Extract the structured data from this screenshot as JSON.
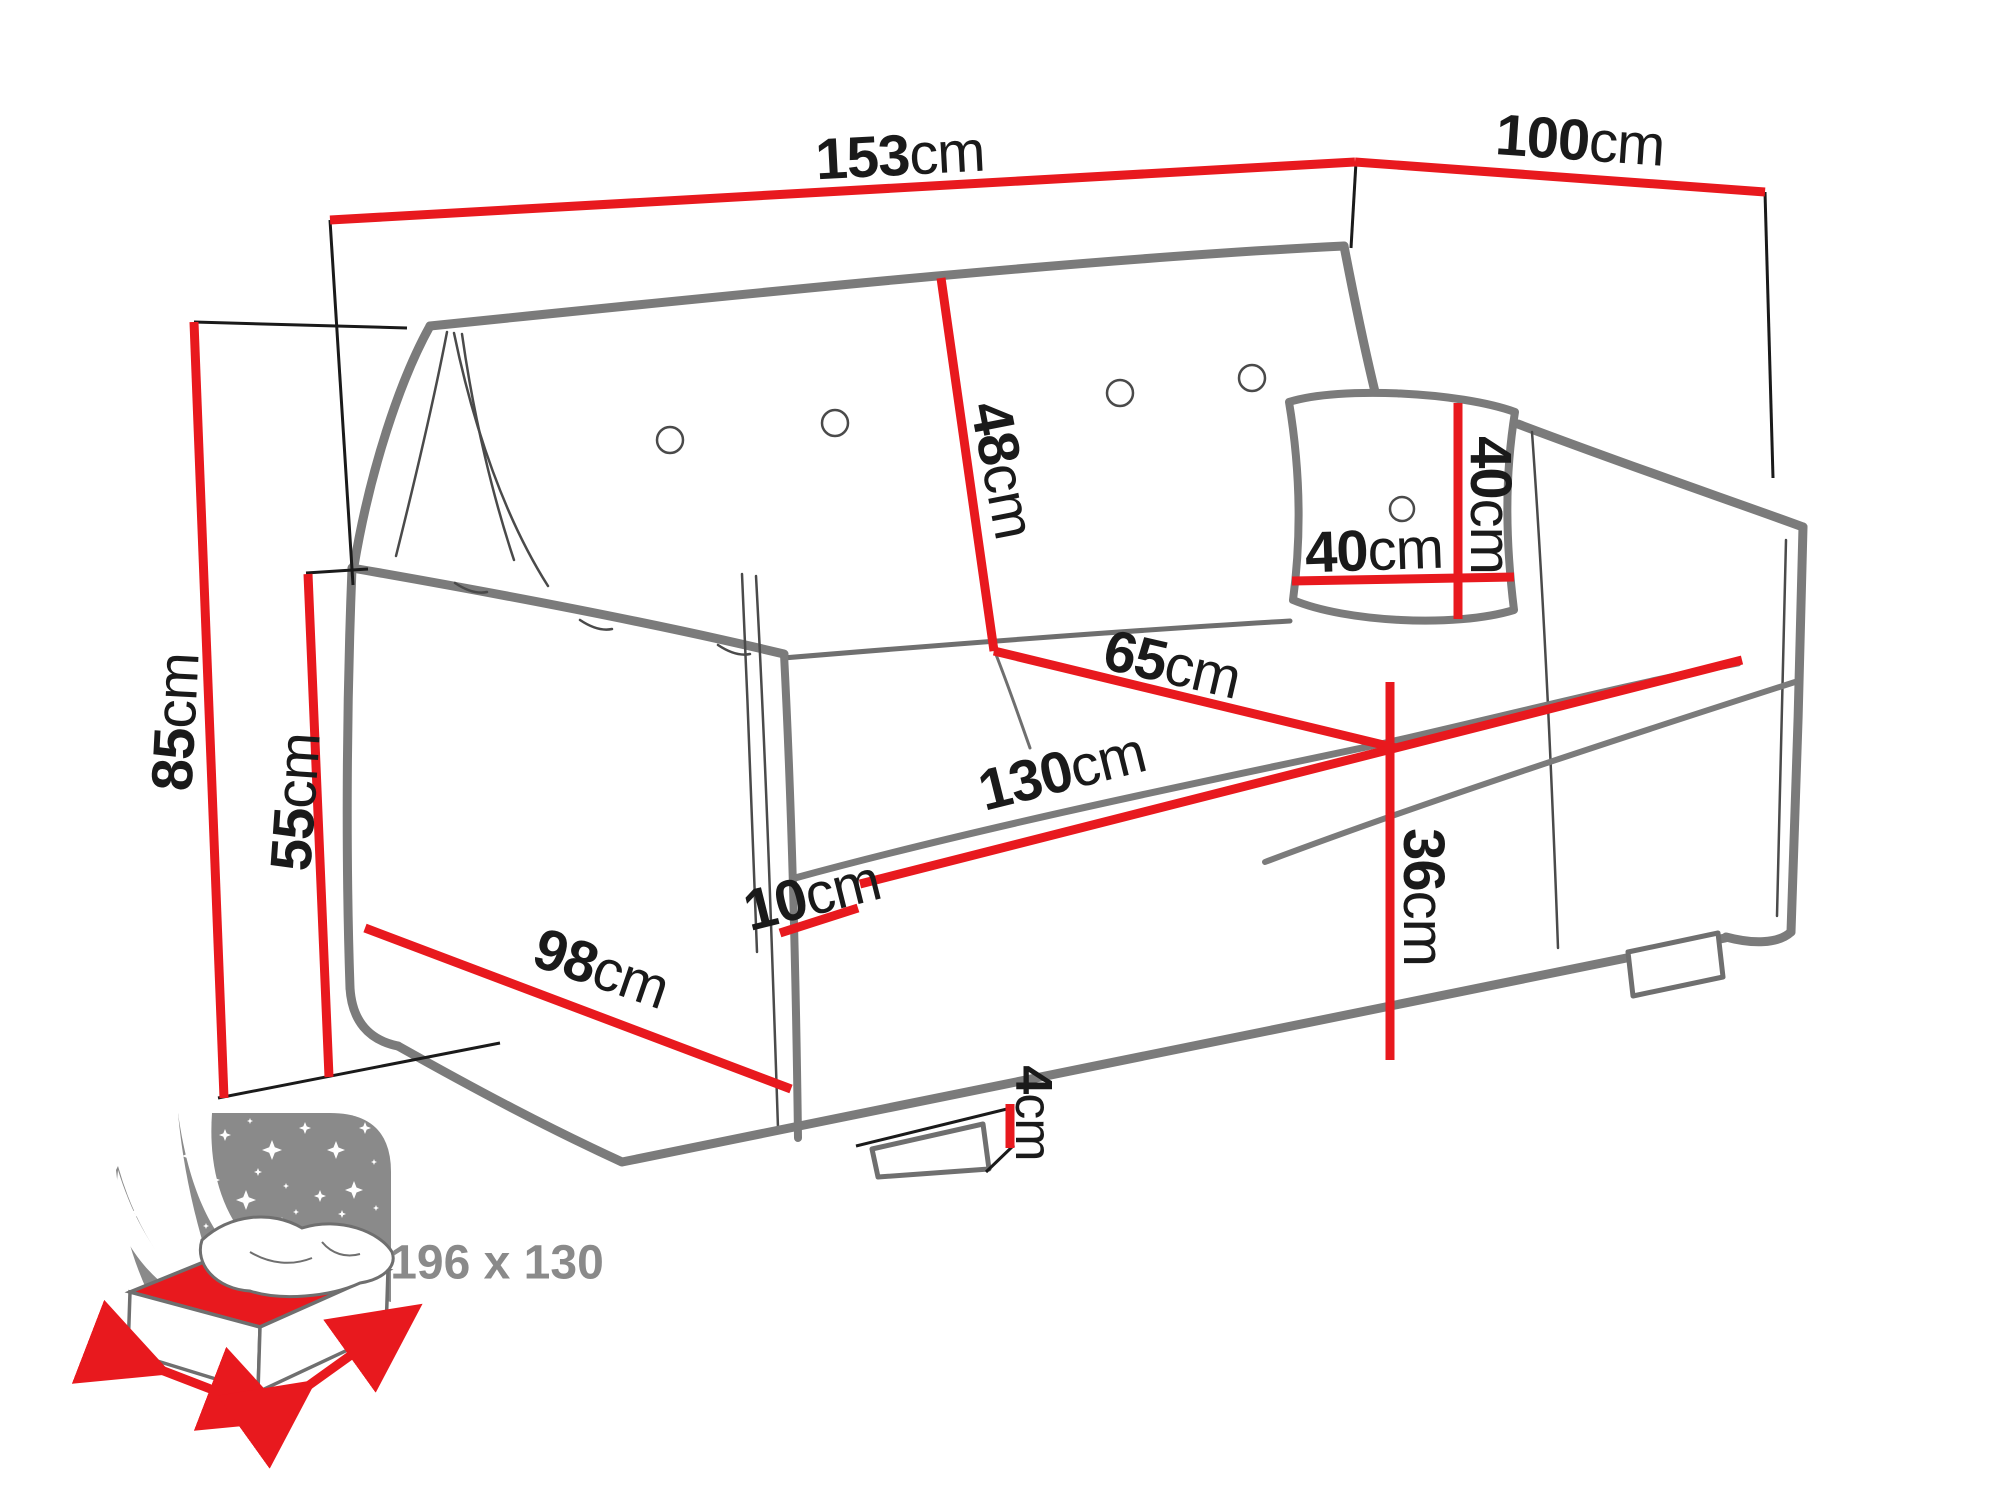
{
  "dims": {
    "overall_width": {
      "num": "153",
      "unit": "cm"
    },
    "overall_depth": {
      "num": "100",
      "unit": "cm"
    },
    "total_height": {
      "num": "85",
      "unit": "cm"
    },
    "armrest_height": {
      "num": "55",
      "unit": "cm"
    },
    "backrest_height": {
      "num": "48",
      "unit": "cm"
    },
    "seat_depth": {
      "num": "65",
      "unit": "cm"
    },
    "seat_width": {
      "num": "130",
      "unit": "cm"
    },
    "armrest_width": {
      "num": "10",
      "unit": "cm"
    },
    "base_depth": {
      "num": "98",
      "unit": "cm"
    },
    "seat_height": {
      "num": "36",
      "unit": "cm"
    },
    "leg_height": {
      "num": "4",
      "unit": "cm"
    },
    "pillow_width": {
      "num": "40",
      "unit": "cm"
    },
    "pillow_height": {
      "num": "40",
      "unit": "cm"
    }
  },
  "bed_icon": {
    "size_label": "196 x 130"
  },
  "colors": {
    "dimension_red": "#e8191e",
    "sofa_outline_gray": "#7b7b7b",
    "label_black": "#1a1a1a",
    "icon_gray": "#8a8a8a"
  }
}
